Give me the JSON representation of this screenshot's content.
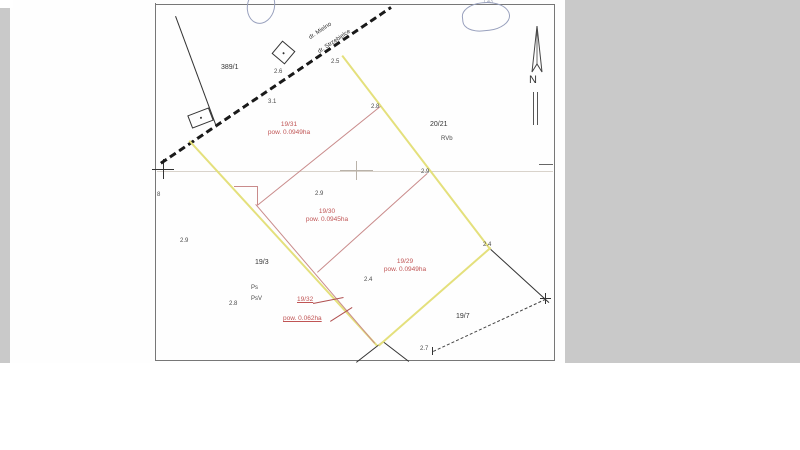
{
  "compass": {
    "north": "N"
  },
  "road": {
    "label_top": "dr. Mielno",
    "label_bottom": "dr. Strzebielce"
  },
  "parcels": {
    "p389_1": {
      "id": "389/1"
    },
    "p20_21": {
      "id": "20/21",
      "land_class": "RVb"
    },
    "p19_3": {
      "id": "19/3",
      "land_class_1": "Ps",
      "land_class_2": "PsV"
    },
    "p19_7": {
      "id": "19/7"
    },
    "p19_31": {
      "id": "19/31",
      "area": "pow. 0.0949ha"
    },
    "p19_30": {
      "id": "19/30",
      "area": "pow. 0.0945ha"
    },
    "p19_29": {
      "id": "19/29",
      "area": "pow. 0.0949ha"
    },
    "p19_32": {
      "id": "19/32",
      "area": "pow. 0.062ha"
    }
  },
  "measurements": [
    {
      "text": "2.6"
    },
    {
      "text": "3.1"
    },
    {
      "text": "2.5"
    },
    {
      "text": "2.8"
    },
    {
      "text": "2.9"
    },
    {
      "text": "2.9"
    },
    {
      "text": "2.9"
    },
    {
      "text": "2.8"
    },
    {
      "text": "2.4"
    },
    {
      "text": "2.4"
    },
    {
      "text": "2.7"
    },
    {
      "text": "8"
    }
  ],
  "handwriting": {
    "mark": "1 43"
  },
  "colors": {
    "boundary_yellow": "#e4e07c",
    "boundary_red": "#c98b8b",
    "red_text": "#c05555",
    "scanner_gray": "#c9c9c9",
    "paper_white": "#fefefe",
    "handwriting_blue": "#98a0bd"
  }
}
